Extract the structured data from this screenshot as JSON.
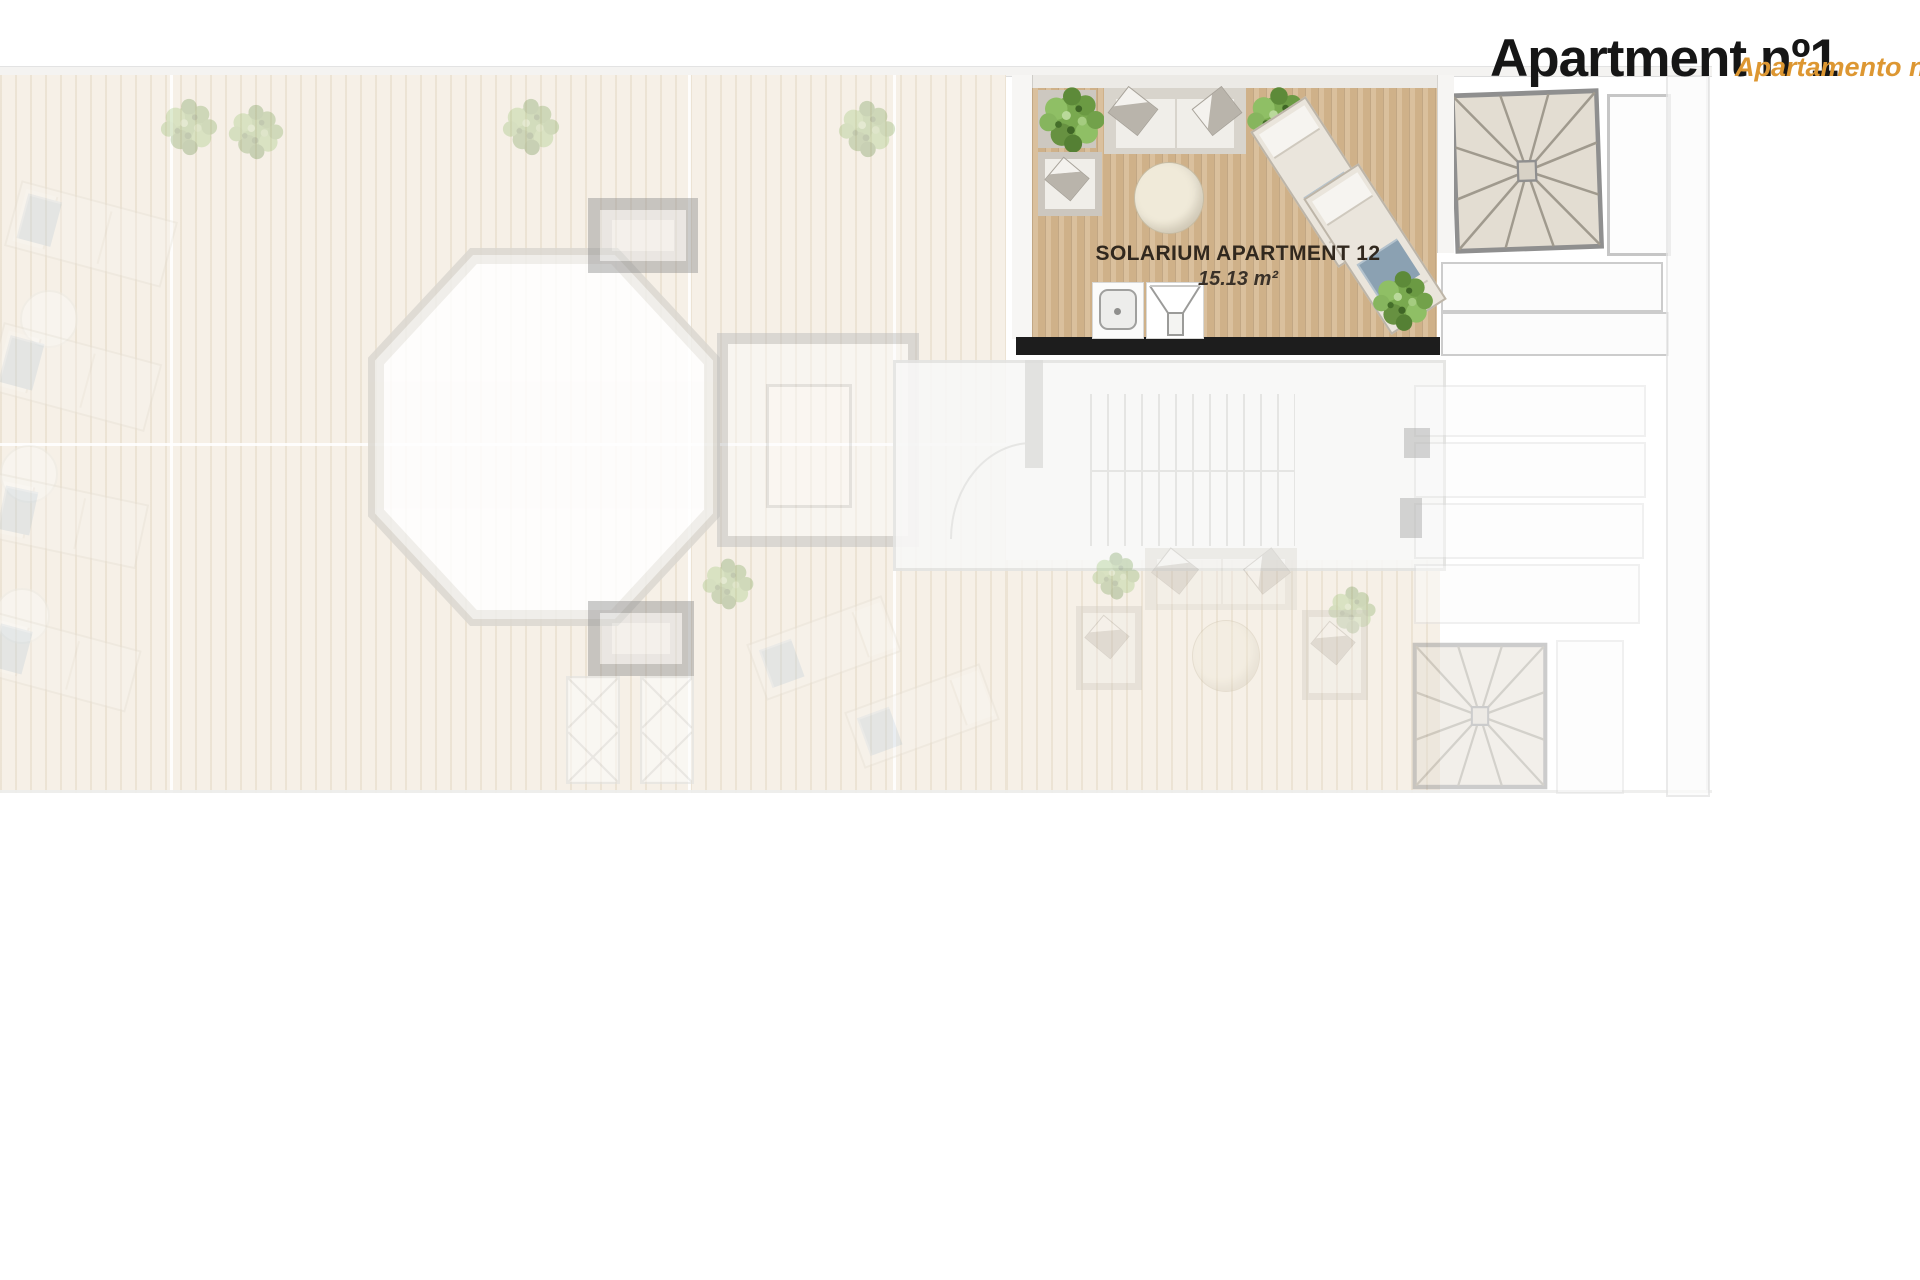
{
  "header": {
    "title": "Apartment nº1",
    "subtitle": "Apartamento nº",
    "title_color": "#161616",
    "subtitle_color": "#dd9732"
  },
  "solarium": {
    "name": "SOLARIUM APARTMENT 12",
    "area": "15.13 m²",
    "floor_color": "#cfb189",
    "label_color": "#31281e",
    "objects": [
      "plant",
      "sofa",
      "plant",
      "armchair",
      "round-table",
      "sun-lounger",
      "sun-lounger",
      "shower-tray",
      "stair-hatch",
      "plant"
    ]
  },
  "plan": {
    "highlighted_unit": "solarium-apartment-12",
    "faded_sections": [
      "pool-deck",
      "communal-pool",
      "skylights",
      "stair-core",
      "interior-stairs",
      "neighbor-solarium",
      "roof-strips",
      "spiral-staircases",
      "deck-loungers",
      "parasol-tables"
    ],
    "colors": {
      "deck": "#f6f0e7",
      "pool": "#ffffff",
      "wall_grey": "#b9b9b9",
      "black_bar": "#1d1d1d",
      "towel_blue": "#8ba1b2",
      "plant_green": "#79a94f",
      "stair_fill": "#e3ddd2"
    }
  }
}
